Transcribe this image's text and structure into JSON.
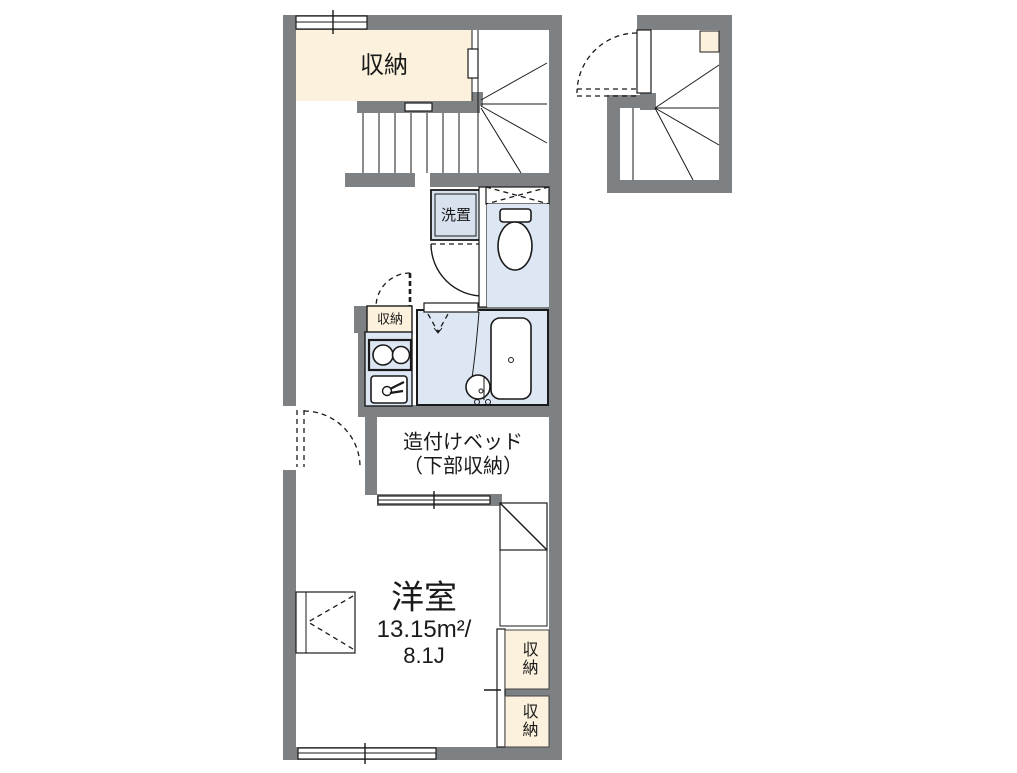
{
  "floor_plan": {
    "unit_main": {
      "storage_top_label": "収納",
      "washer_place_label": "洗置",
      "hall_storage_label": "収納",
      "bed_label_line1": "造付けベッド",
      "bed_label_line2": "（下部収納）",
      "room_name": "洋室",
      "room_area_sqm": "13.15m²/",
      "room_area_tatami": "8.1J",
      "closet_upper_label": "収納",
      "closet_lower_label": "収納"
    },
    "colors": {
      "wall_gray": "#7e8184",
      "storage_cream": "#fbf1dd",
      "wet_area_blue": "#dde7f4",
      "line_black": "#1a1a1a",
      "background": "#ffffff"
    }
  }
}
